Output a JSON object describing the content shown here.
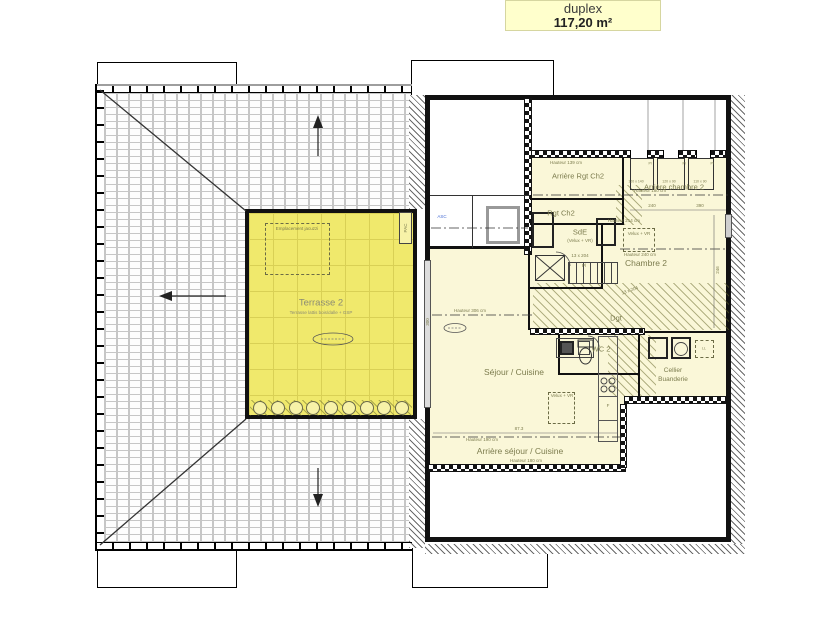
{
  "title": {
    "name": "duplex",
    "area": "117,20 m²"
  },
  "terrace": {
    "label": "Terrasse 2",
    "subtitle": "Terrasse lattis bois/dalle + GSP",
    "jacuzzi": "Emplacement jacuzzi",
    "pac": "PAC"
  },
  "rooms": {
    "arriere_rgt_ch2": "Arrière Rgt Ch2",
    "rgt_ch2": "Rgt Ch2",
    "arriere_chambre2": "Arrière chambre 2",
    "sde": "SdE",
    "sde_note": "(Velux + VR)",
    "chambre2": "Chambre 2",
    "dgt": "Dgt",
    "wc2": "WC 2",
    "cellier": "Cellier",
    "buanderie": "Buanderie",
    "sejour_cuisine": "Séjour / Cuisine",
    "arriere_sejour": "Arrière séjour / Cuisine",
    "asc": "ASC"
  },
  "annotations": {
    "h139": "Hauteur 139 cm",
    "h180": "Hauteur 180 cm",
    "h190": "Hauteur 190 cm",
    "h214": "Hauteur 214 cm",
    "h240": "Hauteur 240 cm",
    "h306": "Hauteur 306 cm",
    "velux": "Velux + VR",
    "stair": "13 x 204",
    "pl": "Pl",
    "ll": "LL",
    "fridge": "F",
    "dim_240": "240",
    "dim_390": "390",
    "dim_246": "246",
    "dim_300": "300",
    "dim_873": "87.3",
    "win_1": "120 x 140",
    "win_2": "120 x 90",
    "win_3": "110 x 90"
  },
  "colors": {
    "title_bg": "#ffffcc",
    "terrace_fill": "#f0e96c",
    "room_fill": "#faf7d8",
    "wall": "#111111",
    "label_olive": "#7c7c4e",
    "label_gray": "#8b8b74",
    "asc_blue": "#4a6fd4"
  }
}
